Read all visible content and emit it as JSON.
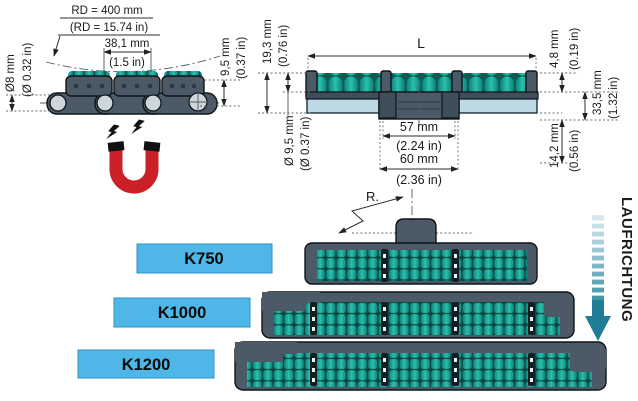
{
  "side_view": {
    "rd_mm": "RD = 400 mm",
    "rd_in": "(RD = 15.74 in)",
    "pitch_mm": "38,1 mm",
    "pitch_in": "(1.5 in)",
    "pin_mm": "Ø8 mm",
    "pin_in": "(Ø 0.32 in)",
    "plate_mm": "9,5 mm",
    "plate_in": "(0.37 in)"
  },
  "front_view": {
    "width_label": "L",
    "height_mm": "19,3 mm",
    "height_in": "(0.76 in)",
    "roller_mm": "Ø 9,5 mm",
    "roller_in": "(Ø 0.37 in)",
    "top_mm": "4,8 mm",
    "top_in": "(0.19 in)",
    "side_mm": "33,5 mm",
    "side_in": "(1.32 in)",
    "bottom_mm": "14,2 mm",
    "bottom_in": "(0.56 in)",
    "hub_mm": "57 mm",
    "hub_in": "(2.24 in)",
    "hub2_mm": "60 mm",
    "hub2_in": "(2.36 in)"
  },
  "overview": {
    "radius_label": "R.",
    "direction_label": "LAUFRICHTUNG",
    "models": [
      {
        "label": "K750"
      },
      {
        "label": "K1000"
      },
      {
        "label": "K1200"
      }
    ]
  },
  "colors": {
    "model_label_blue": "#4fb6e8",
    "roller_teal": "#14a093",
    "chain_gray": "#4b5a66",
    "plate_light_blue": "#bdd9e3",
    "magnet_red": "#cb2027",
    "direction_arrow_teal": "#1f7d95"
  }
}
